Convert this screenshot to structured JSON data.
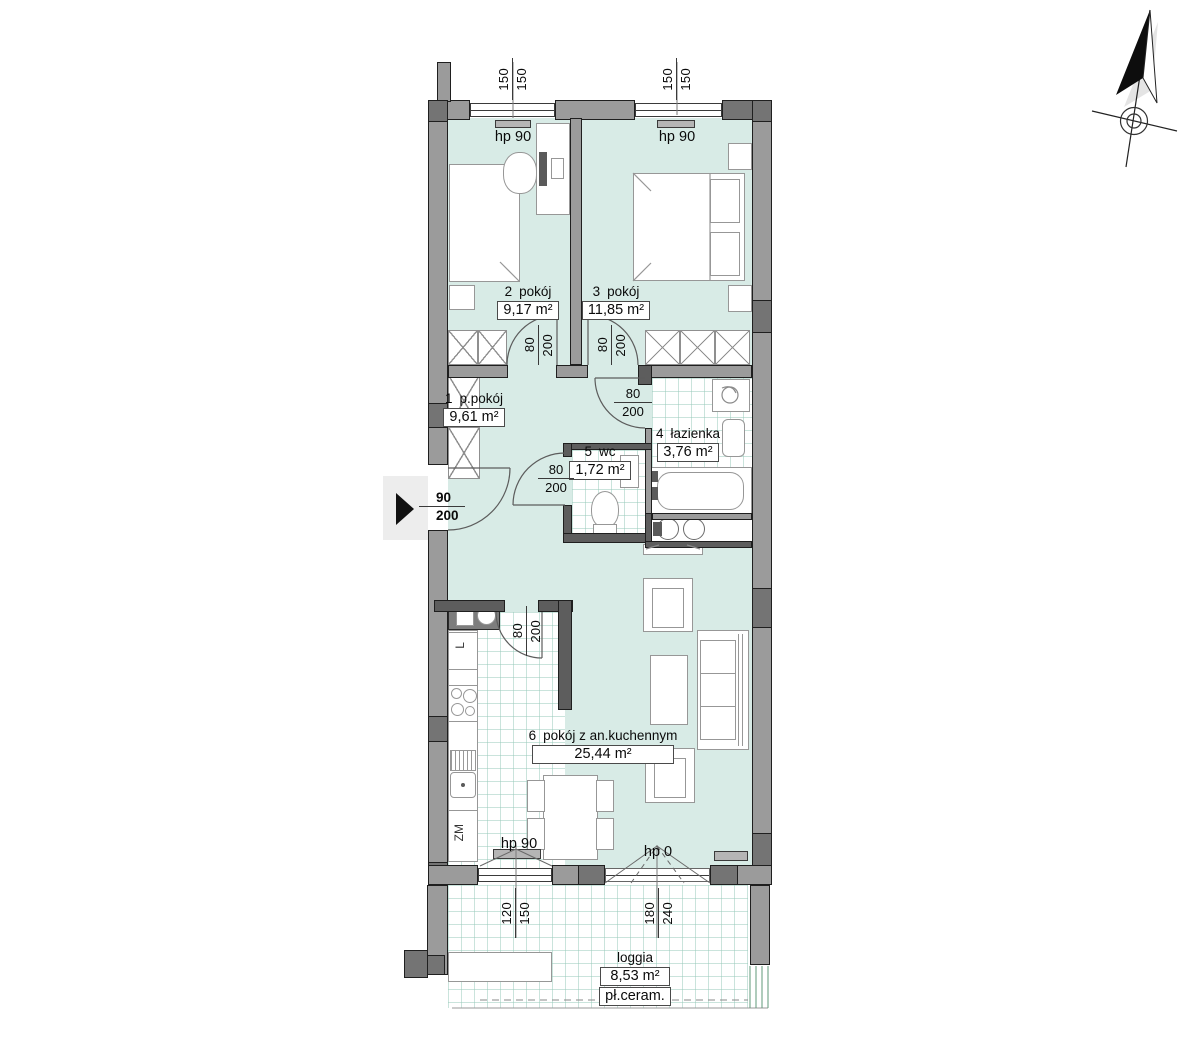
{
  "rooms": {
    "r1": {
      "num": "1",
      "name": "p.pokój",
      "area": "9,61 m²"
    },
    "r2": {
      "num": "2",
      "name": "pokój",
      "area": "9,17 m²"
    },
    "r3": {
      "num": "3",
      "name": "pokój",
      "area": "11,85 m²"
    },
    "r4": {
      "num": "4",
      "name": "łazienka",
      "area": "3,76 m²"
    },
    "r5": {
      "num": "5",
      "name": "wc",
      "area": "1,72 m²"
    },
    "r6": {
      "num": "6",
      "name": "pokój z an.kuchennym",
      "area": "25,44 m²"
    },
    "loggia": {
      "name": "loggia",
      "area": "8,53 m²",
      "floor": "pł.ceram."
    }
  },
  "window_dims": {
    "room2": {
      "a": "150",
      "b": "150"
    },
    "room3": {
      "a": "150",
      "b": "150"
    },
    "kitchen": {
      "a": "120",
      "b": "150"
    },
    "balcony": {
      "a": "180",
      "b": "240"
    }
  },
  "door_dims": {
    "room2": {
      "w": "80",
      "h": "200"
    },
    "room3": {
      "w": "80",
      "h": "200"
    },
    "bathroom": {
      "w": "80",
      "h": "200"
    },
    "wc": {
      "w": "80",
      "h": "200"
    },
    "kitchen": {
      "w": "80",
      "h": "200"
    },
    "entrance": {
      "w": "90",
      "h": "200"
    }
  },
  "sill_labels": {
    "room2": "hp 90",
    "room3": "hp 90",
    "kitchen": "hp 90",
    "balcony": "hp 0"
  },
  "kitchen_labels": {
    "fridge": "L",
    "dishwasher": "ZM"
  },
  "colors": {
    "room_fill": "#d8ebe6",
    "tile_line": "#cfe7e0",
    "wall": "#9b9b9b",
    "wall_dark": "#5d5d5d",
    "entrance_arrow": "#111111"
  }
}
